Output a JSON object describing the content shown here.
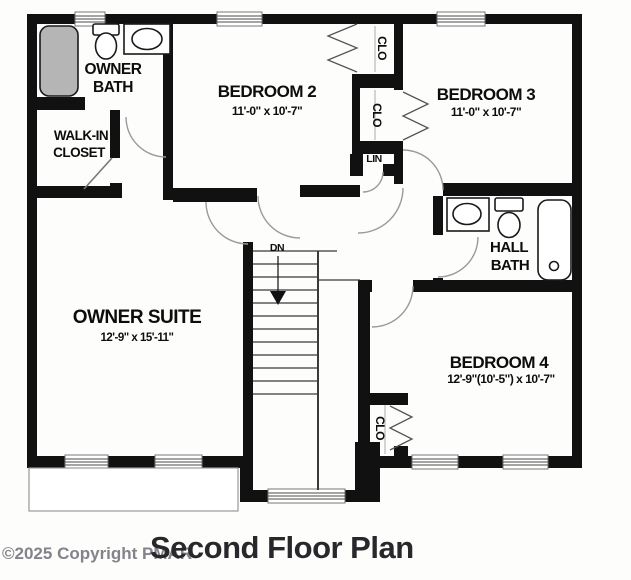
{
  "title": "Second Floor Plan",
  "watermark": "©2025 Copyright PMAR",
  "rooms": {
    "bedroom2": {
      "label": "BEDROOM 2",
      "dims": "11'-0\" x 10'-7\""
    },
    "bedroom3": {
      "label": "BEDROOM 3",
      "dims": "11'-0\" x 10'-7\""
    },
    "bedroom4": {
      "label": "BEDROOM 4",
      "dims": "12'-9\"(10'-5\") x 10'-7\""
    },
    "owner_suite": {
      "label": "OWNER SUITE",
      "dims": "12'-9\" x 15'-11\""
    },
    "owner_bath": {
      "line1": "OWNER",
      "line2": "BATH"
    },
    "walk_in_closet": {
      "line1": "WALK-IN",
      "line2": "CLOSET"
    },
    "hall_bath": {
      "line1": "HALL",
      "line2": "BATH"
    },
    "closet_bedroom2": {
      "label": "CLO"
    },
    "closet_bedroom3": {
      "label": "CLO"
    },
    "closet_bedroom4": {
      "label": "CLO"
    },
    "linen_closet": {
      "label": "LIN"
    },
    "stairs": {
      "down_label": "DN"
    }
  },
  "colors": {
    "wall": "#111111",
    "tub_fill": "#b5b5b5",
    "title_text": "#28282c",
    "watermark_text": "#83838b",
    "door_arc": "#9a9a9a"
  }
}
